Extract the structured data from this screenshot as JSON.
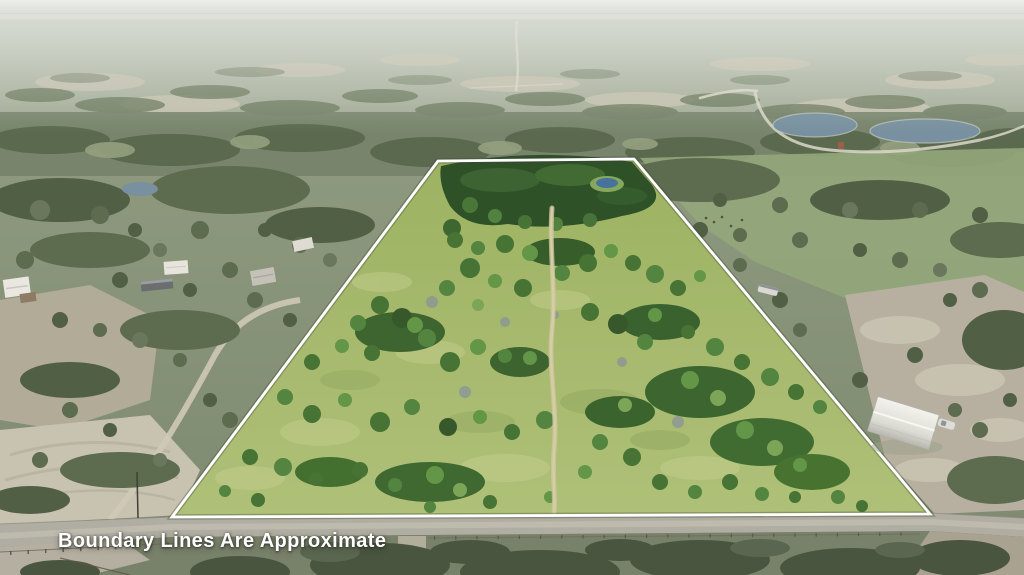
{
  "photo": {
    "disclaimer": "Boundary Lines Are Approximate",
    "subject": "Aerial drone view of rural wooded acreage outlined by a white approximate property boundary, with a center dirt trail, ponds, a gravel county road along the frontage, and neighboring farm buildings"
  },
  "boundary": {
    "shape": "trapezoid",
    "points": "438,161 634,159 930,514 172,517",
    "color": "#ffffff"
  },
  "colors": {
    "sky_haze": "#e7eae5",
    "distant_land": "#aab3a0",
    "outside_pasture": "#8d9a7e",
    "property_grass": "#a8bb70",
    "tree_dark": "#36582a",
    "tree_light": "#649648",
    "dirt_path": "#d6cda6",
    "road": "#b0ada2",
    "pond_water": "#78909f",
    "property_pond": "#46729b",
    "boundary_line": "#ffffff",
    "disclaimer_text": "#ffffff"
  }
}
